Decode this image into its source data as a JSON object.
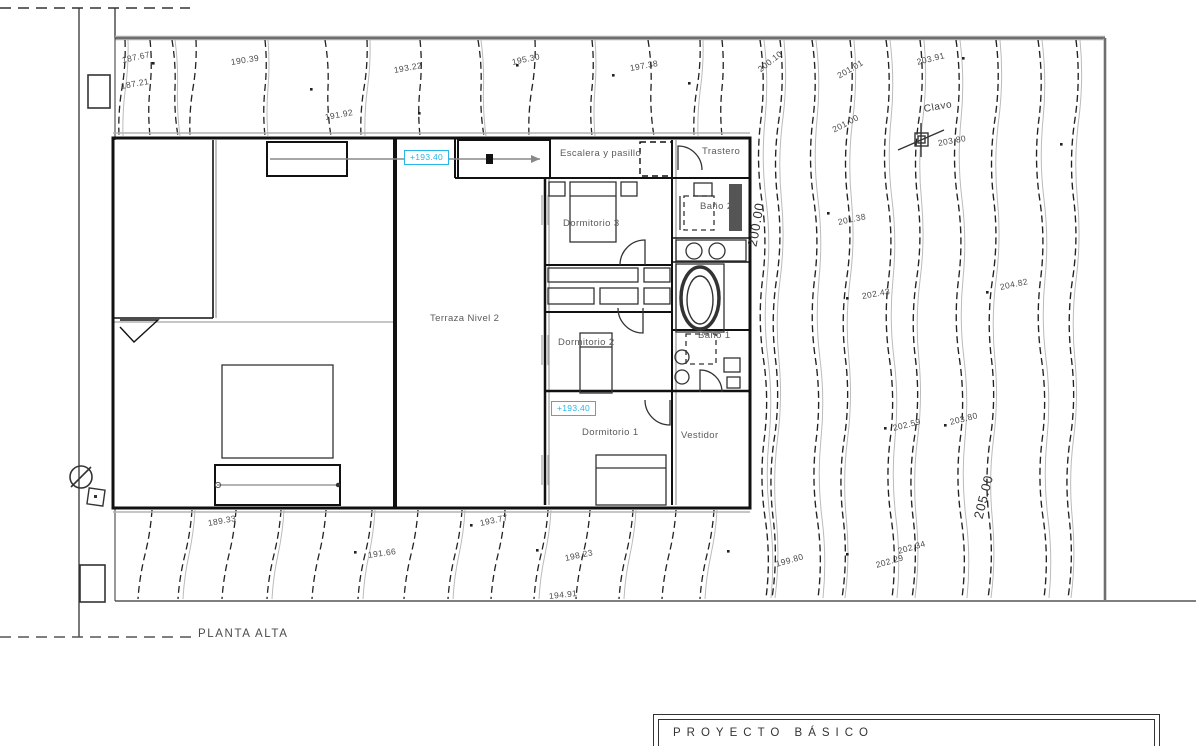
{
  "accent": "#29b6e8",
  "floor_label": "PLANTA ALTA",
  "title_block": {
    "title": "PROYECTO BÁSICO"
  },
  "rooms": [
    {
      "label": "Terraza Nivel 2",
      "x": 430,
      "y": 314
    },
    {
      "label": "Dormitorio 3",
      "x": 563,
      "y": 219
    },
    {
      "label": "Dormitorio 2",
      "x": 558,
      "y": 338
    },
    {
      "label": "Dormitorio 1",
      "x": 582,
      "y": 428
    },
    {
      "label": "Vestidor",
      "x": 681,
      "y": 431
    },
    {
      "label": "Trastero",
      "x": 702,
      "y": 147
    },
    {
      "label": "Baño 2",
      "x": 700,
      "y": 202
    },
    {
      "label": "Baño 1",
      "x": 698,
      "y": 331
    },
    {
      "label": "Escalera y pasillo",
      "x": 560,
      "y": 149
    }
  ],
  "elevation_badges": [
    {
      "label": "+193.40",
      "x": 404,
      "y": 150
    },
    {
      "label": "+193.40",
      "x": 551,
      "y": 401
    }
  ],
  "survey_point": {
    "label": "Clavo",
    "x": 924,
    "y": 104,
    "rot": -10
  },
  "contour_labels": [
    {
      "label": "187.67",
      "x": 122,
      "y": 56,
      "rot": -12
    },
    {
      "label": "187.21",
      "x": 121,
      "y": 82,
      "rot": -10
    },
    {
      "label": "190.39",
      "x": 231,
      "y": 58,
      "rot": -9
    },
    {
      "label": "191.92",
      "x": 325,
      "y": 113,
      "rot": -10
    },
    {
      "label": "193.22",
      "x": 394,
      "y": 66,
      "rot": -10
    },
    {
      "label": "195.30",
      "x": 512,
      "y": 58,
      "rot": -12
    },
    {
      "label": "197.38",
      "x": 630,
      "y": 64,
      "rot": -10
    },
    {
      "label": "200.10",
      "x": 759,
      "y": 66,
      "rot": -38
    },
    {
      "label": "201.01",
      "x": 838,
      "y": 72,
      "rot": -30
    },
    {
      "label": "203.91",
      "x": 917,
      "y": 58,
      "rot": -14
    },
    {
      "label": "201.00",
      "x": 833,
      "y": 126,
      "rot": -28
    },
    {
      "label": "203.80",
      "x": 938,
      "y": 139,
      "rot": -10
    },
    {
      "label": "200.00",
      "x": 752,
      "y": 240,
      "rot": -80,
      "big": true
    },
    {
      "label": "201.38",
      "x": 838,
      "y": 218,
      "rot": -12
    },
    {
      "label": "202.43",
      "x": 862,
      "y": 292,
      "rot": -10
    },
    {
      "label": "204.82",
      "x": 1000,
      "y": 283,
      "rot": -12
    },
    {
      "label": "202.59",
      "x": 893,
      "y": 424,
      "rot": -14
    },
    {
      "label": "203.80",
      "x": 950,
      "y": 418,
      "rot": -14
    },
    {
      "label": "205.00",
      "x": 978,
      "y": 512,
      "rot": -76,
      "big": true
    },
    {
      "label": "189.33",
      "x": 208,
      "y": 519,
      "rot": -10
    },
    {
      "label": "193.77",
      "x": 480,
      "y": 519,
      "rot": -12
    },
    {
      "label": "191.66",
      "x": 368,
      "y": 551,
      "rot": -8
    },
    {
      "label": "198.23",
      "x": 565,
      "y": 554,
      "rot": -12
    },
    {
      "label": "194.91",
      "x": 549,
      "y": 592,
      "rot": -6
    },
    {
      "label": "199.80",
      "x": 776,
      "y": 560,
      "rot": -16
    },
    {
      "label": "202.34",
      "x": 898,
      "y": 547,
      "rot": -16
    },
    {
      "label": "202.29",
      "x": 876,
      "y": 561,
      "rot": -16
    }
  ]
}
